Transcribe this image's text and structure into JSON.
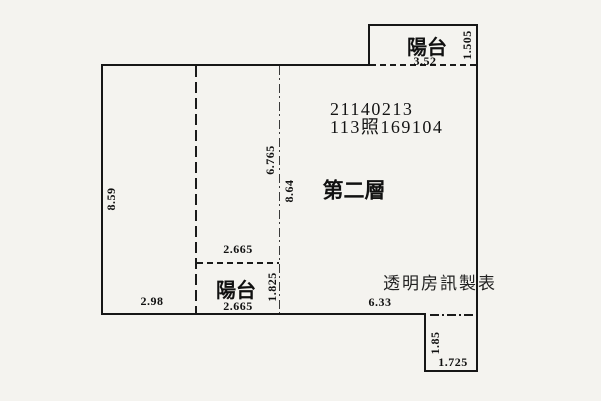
{
  "canvas": {
    "background": "#f4f3ef",
    "line_color": "#161616"
  },
  "annotations": {
    "case_number": "21140213",
    "permit_number": "113照169104",
    "floor_label": "第二層",
    "watermark": "透明房訊製表"
  },
  "balcony_top": {
    "label": "陽台",
    "width": "3.52",
    "depth": "1.505"
  },
  "balcony_bottom": {
    "label": "陽台",
    "width_top": "2.665",
    "width_bottom": "2.665",
    "depth": "1.825"
  },
  "main_room": {
    "left_height": "8.59",
    "center_height_left": "6.765",
    "center_height_right": "8.64",
    "bottom_left_width": "2.98",
    "bottom_right_width": "6.33"
  },
  "notch_bottom_right": {
    "height": "1.85",
    "width": "1.725"
  }
}
